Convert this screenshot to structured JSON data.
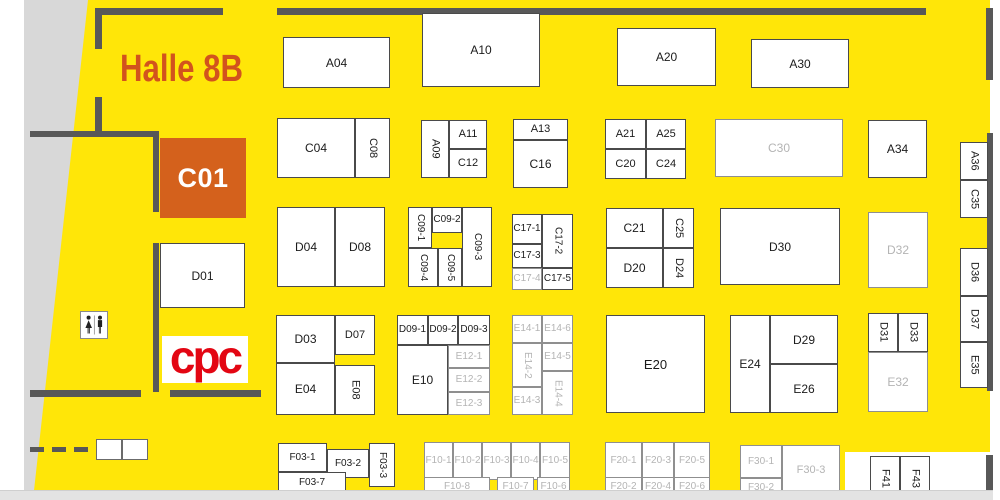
{
  "title": "Halle 8B",
  "logo_text": "cpc",
  "selected_booth": "C01",
  "colors": {
    "hall_bg": "#ffe608",
    "selected_bg": "#d4611c",
    "title_color": "#d2531d",
    "logo_color": "#e30613",
    "booth_text": "#1b1b1b",
    "inactive_text": "#b4b4b4",
    "wall": "#585858"
  },
  "booths": [
    {
      "label": "A04",
      "x": 283,
      "y": 37,
      "w": 107,
      "h": 51,
      "fs": 12
    },
    {
      "label": "A10",
      "x": 422,
      "y": 13,
      "w": 118,
      "h": 74,
      "fs": 12
    },
    {
      "label": "A20",
      "x": 617,
      "y": 28,
      "w": 99,
      "h": 58,
      "fs": 12
    },
    {
      "label": "A30",
      "x": 751,
      "y": 39,
      "w": 98,
      "h": 49,
      "fs": 12
    },
    {
      "label": "C04",
      "x": 277,
      "y": 118,
      "w": 78,
      "h": 60,
      "fs": 12
    },
    {
      "label": "C08",
      "x": 355,
      "y": 118,
      "w": 35,
      "h": 60,
      "o": "v"
    },
    {
      "label": "A09",
      "x": 421,
      "y": 120,
      "w": 28,
      "h": 58,
      "o": "v"
    },
    {
      "label": "A11",
      "x": 449,
      "y": 120,
      "w": 38,
      "h": 29
    },
    {
      "label": "C12",
      "x": 449,
      "y": 149,
      "w": 38,
      "h": 29
    },
    {
      "label": "A13",
      "x": 513,
      "y": 119,
      "w": 55,
      "h": 21
    },
    {
      "label": "C16",
      "x": 513,
      "y": 140,
      "w": 55,
      "h": 48,
      "fs": 12
    },
    {
      "label": "A21",
      "x": 605,
      "y": 119,
      "w": 41,
      "h": 30
    },
    {
      "label": "A25",
      "x": 646,
      "y": 119,
      "w": 40,
      "h": 30
    },
    {
      "label": "C20",
      "x": 605,
      "y": 149,
      "w": 41,
      "h": 30
    },
    {
      "label": "C24",
      "x": 646,
      "y": 149,
      "w": 40,
      "h": 30
    },
    {
      "label": "C30",
      "x": 715,
      "y": 119,
      "w": 128,
      "h": 58,
      "s": "gray",
      "fs": 12
    },
    {
      "label": "A34",
      "x": 868,
      "y": 120,
      "w": 59,
      "h": 58,
      "fs": 12
    },
    {
      "label": "A36",
      "x": 960,
      "y": 142,
      "w": 28,
      "h": 38,
      "o": "v"
    },
    {
      "label": "C35",
      "x": 960,
      "y": 180,
      "w": 28,
      "h": 38,
      "o": "v"
    },
    {
      "label": "C01",
      "x": 160,
      "y": 138,
      "w": 86,
      "h": 80,
      "s": "selected"
    },
    {
      "label": "D01",
      "x": 160,
      "y": 243,
      "w": 85,
      "h": 65,
      "fs": 12
    },
    {
      "label": "D04",
      "x": 277,
      "y": 207,
      "w": 58,
      "h": 80,
      "fs": 12
    },
    {
      "label": "D08",
      "x": 335,
      "y": 207,
      "w": 50,
      "h": 80,
      "fs": 12
    },
    {
      "label": "C09-1",
      "x": 408,
      "y": 207,
      "w": 24,
      "h": 41,
      "o": "v",
      "fs": 10
    },
    {
      "label": "C09-2",
      "x": 432,
      "y": 207,
      "w": 30,
      "h": 26,
      "fs": 10
    },
    {
      "label": "C09-3",
      "x": 462,
      "y": 207,
      "w": 30,
      "h": 80,
      "o": "v",
      "fs": 10
    },
    {
      "label": "C09-4",
      "x": 408,
      "y": 248,
      "w": 30,
      "h": 39,
      "o": "v",
      "fs": 10
    },
    {
      "label": "C09-5",
      "x": 438,
      "y": 248,
      "w": 24,
      "h": 39,
      "o": "v",
      "fs": 10
    },
    {
      "label": "C17-1",
      "x": 512,
      "y": 214,
      "w": 30,
      "h": 30,
      "fs": 10
    },
    {
      "label": "C17-2",
      "x": 542,
      "y": 214,
      "w": 31,
      "h": 54,
      "o": "v",
      "fs": 10
    },
    {
      "label": "C17-3",
      "x": 512,
      "y": 244,
      "w": 30,
      "h": 24,
      "fs": 10
    },
    {
      "label": "C17-4",
      "x": 512,
      "y": 268,
      "w": 30,
      "h": 22,
      "s": "gray",
      "fs": 10
    },
    {
      "label": "C17-5",
      "x": 542,
      "y": 268,
      "w": 31,
      "h": 22,
      "fs": 10
    },
    {
      "label": "C21",
      "x": 606,
      "y": 208,
      "w": 57,
      "h": 40,
      "fs": 12
    },
    {
      "label": "C25",
      "x": 663,
      "y": 208,
      "w": 31,
      "h": 40,
      "o": "v"
    },
    {
      "label": "D20",
      "x": 606,
      "y": 248,
      "w": 57,
      "h": 40,
      "fs": 12
    },
    {
      "label": "D24",
      "x": 663,
      "y": 248,
      "w": 31,
      "h": 40,
      "o": "v"
    },
    {
      "label": "D30",
      "x": 720,
      "y": 208,
      "w": 120,
      "h": 77,
      "fs": 12
    },
    {
      "label": "D32",
      "x": 868,
      "y": 212,
      "w": 60,
      "h": 76,
      "s": "gray",
      "fs": 12
    },
    {
      "label": "D36",
      "x": 960,
      "y": 248,
      "w": 28,
      "h": 48,
      "o": "v"
    },
    {
      "label": "D37",
      "x": 960,
      "y": 296,
      "w": 28,
      "h": 46,
      "o": "v"
    },
    {
      "label": "E35",
      "x": 960,
      "y": 342,
      "w": 28,
      "h": 46,
      "o": "v"
    },
    {
      "label": "D03",
      "x": 276,
      "y": 315,
      "w": 59,
      "h": 48,
      "fs": 12
    },
    {
      "label": "D07",
      "x": 335,
      "y": 315,
      "w": 40,
      "h": 40
    },
    {
      "label": "E04",
      "x": 276,
      "y": 363,
      "w": 59,
      "h": 52,
      "fs": 12
    },
    {
      "label": "E08",
      "x": 335,
      "y": 365,
      "w": 40,
      "h": 50,
      "o": "v"
    },
    {
      "label": "D09-1",
      "x": 397,
      "y": 315,
      "w": 31,
      "h": 30,
      "fs": 10
    },
    {
      "label": "D09-2",
      "x": 428,
      "y": 315,
      "w": 30,
      "h": 30,
      "fs": 10
    },
    {
      "label": "D09-3",
      "x": 458,
      "y": 315,
      "w": 32,
      "h": 30,
      "fs": 10
    },
    {
      "label": "E10",
      "x": 397,
      "y": 345,
      "w": 51,
      "h": 70,
      "fs": 12
    },
    {
      "label": "E12-1",
      "x": 448,
      "y": 345,
      "w": 42,
      "h": 23,
      "s": "gray",
      "fs": 10
    },
    {
      "label": "E12-2",
      "x": 448,
      "y": 368,
      "w": 42,
      "h": 24,
      "s": "gray",
      "fs": 10
    },
    {
      "label": "E12-3",
      "x": 448,
      "y": 392,
      "w": 42,
      "h": 23,
      "s": "gray",
      "fs": 10
    },
    {
      "label": "E14-1",
      "x": 512,
      "y": 315,
      "w": 30,
      "h": 28,
      "s": "gray",
      "fs": 10
    },
    {
      "label": "E14-6",
      "x": 542,
      "y": 315,
      "w": 31,
      "h": 28,
      "s": "gray",
      "fs": 10
    },
    {
      "label": "E14-2",
      "x": 512,
      "y": 343,
      "w": 30,
      "h": 44,
      "o": "v",
      "s": "gray",
      "fs": 10
    },
    {
      "label": "E14-5",
      "x": 542,
      "y": 343,
      "w": 31,
      "h": 28,
      "s": "gray",
      "fs": 10
    },
    {
      "label": "E14-3",
      "x": 512,
      "y": 387,
      "w": 30,
      "h": 28,
      "s": "gray",
      "fs": 10
    },
    {
      "label": "E14-4",
      "x": 542,
      "y": 371,
      "w": 31,
      "h": 44,
      "o": "v",
      "s": "gray",
      "fs": 10
    },
    {
      "label": "E20",
      "x": 606,
      "y": 315,
      "w": 99,
      "h": 98,
      "fs": 13
    },
    {
      "label": "E24",
      "x": 730,
      "y": 315,
      "w": 40,
      "h": 98,
      "fs": 12
    },
    {
      "label": "D29",
      "x": 770,
      "y": 315,
      "w": 68,
      "h": 49,
      "fs": 12
    },
    {
      "label": "E26",
      "x": 770,
      "y": 364,
      "w": 68,
      "h": 49,
      "fs": 12
    },
    {
      "label": "D31",
      "x": 868,
      "y": 313,
      "w": 30,
      "h": 39,
      "o": "v"
    },
    {
      "label": "D33",
      "x": 898,
      "y": 313,
      "w": 30,
      "h": 39,
      "o": "v"
    },
    {
      "label": "E32",
      "x": 868,
      "y": 352,
      "w": 60,
      "h": 60,
      "s": "gray",
      "fs": 12
    },
    {
      "label": "F03-1",
      "x": 278,
      "y": 443,
      "w": 49,
      "h": 29,
      "fs": 10
    },
    {
      "label": "F03-2",
      "x": 327,
      "y": 449,
      "w": 42,
      "h": 29,
      "fs": 10
    },
    {
      "label": "F03-3",
      "x": 369,
      "y": 443,
      "w": 26,
      "h": 44,
      "o": "v",
      "fs": 10
    },
    {
      "label": "F03-7",
      "x": 278,
      "y": 472,
      "w": 68,
      "h": 21,
      "fs": 10
    },
    {
      "label": "F10-1",
      "x": 424,
      "y": 442,
      "w": 29,
      "h": 38,
      "s": "gray",
      "fs": 10
    },
    {
      "label": "F10-2",
      "x": 453,
      "y": 442,
      "w": 29,
      "h": 38,
      "s": "gray",
      "fs": 10
    },
    {
      "label": "F10-3",
      "x": 482,
      "y": 442,
      "w": 29,
      "h": 38,
      "s": "gray",
      "fs": 10
    },
    {
      "label": "F10-4",
      "x": 511,
      "y": 442,
      "w": 29,
      "h": 38,
      "s": "gray",
      "fs": 10
    },
    {
      "label": "F10-5",
      "x": 540,
      "y": 442,
      "w": 30,
      "h": 38,
      "s": "gray",
      "fs": 10
    },
    {
      "label": "F10-8",
      "x": 424,
      "y": 477,
      "w": 66,
      "h": 20,
      "s": "gray",
      "fs": 10
    },
    {
      "label": "F10-7",
      "x": 497,
      "y": 477,
      "w": 37,
      "h": 20,
      "s": "gray",
      "fs": 10
    },
    {
      "label": "F10-6",
      "x": 537,
      "y": 477,
      "w": 33,
      "h": 20,
      "s": "gray",
      "fs": 10
    },
    {
      "label": "F20-1",
      "x": 605,
      "y": 442,
      "w": 37,
      "h": 38,
      "s": "gray",
      "fs": 10
    },
    {
      "label": "F20-3",
      "x": 642,
      "y": 442,
      "w": 32,
      "h": 38,
      "s": "gray",
      "fs": 10
    },
    {
      "label": "F20-5",
      "x": 674,
      "y": 442,
      "w": 36,
      "h": 38,
      "s": "gray",
      "fs": 10
    },
    {
      "label": "F20-2",
      "x": 605,
      "y": 477,
      "w": 37,
      "h": 20,
      "s": "gray",
      "fs": 10
    },
    {
      "label": "F20-4",
      "x": 642,
      "y": 477,
      "w": 32,
      "h": 20,
      "s": "gray",
      "fs": 10
    },
    {
      "label": "F20-6",
      "x": 674,
      "y": 477,
      "w": 36,
      "h": 20,
      "s": "gray",
      "fs": 10
    },
    {
      "label": "F30-1",
      "x": 740,
      "y": 445,
      "w": 42,
      "h": 33,
      "s": "gray",
      "fs": 10
    },
    {
      "label": "F30-2",
      "x": 740,
      "y": 478,
      "w": 42,
      "h": 19,
      "s": "gray",
      "fs": 10
    },
    {
      "label": "F30-3",
      "x": 782,
      "y": 445,
      "w": 58,
      "h": 50,
      "s": "gray"
    },
    {
      "label": "F41",
      "x": 870,
      "y": 456,
      "w": 30,
      "h": 44,
      "o": "v"
    },
    {
      "label": "F43",
      "x": 900,
      "y": 456,
      "w": 30,
      "h": 44,
      "o": "v"
    }
  ]
}
